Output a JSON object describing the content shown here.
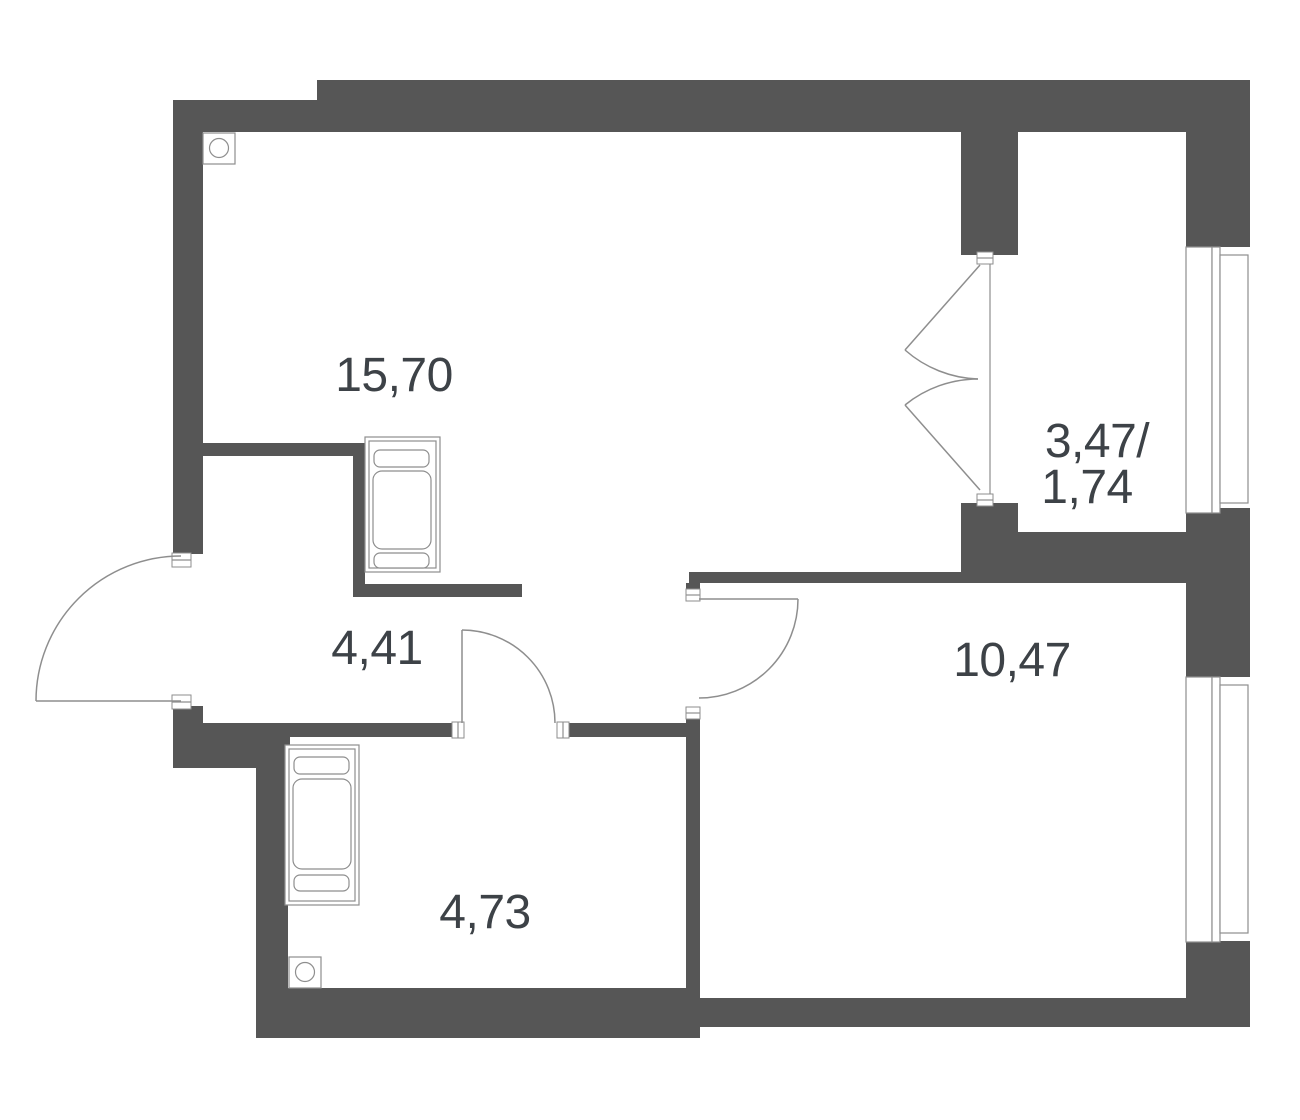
{
  "plan": {
    "type": "apartment-floor-plan",
    "colors": {
      "wall": "#565656",
      "line": "#8e8e8e",
      "text": "#3d4247",
      "background": "#ffffff"
    },
    "labels": {
      "living": "15,70",
      "hallway": "4,41",
      "bathroom": "4,73",
      "bedroom": "10,47",
      "balcony_total": "3,47/",
      "balcony_reduced": "1,74"
    },
    "rooms": [
      {
        "id": "living-room",
        "area": "15,70"
      },
      {
        "id": "hallway",
        "area": "4,41"
      },
      {
        "id": "bathroom",
        "area": "4,73"
      },
      {
        "id": "bedroom",
        "area": "10,47"
      },
      {
        "id": "balcony",
        "area": "3,47/1,74"
      }
    ]
  }
}
